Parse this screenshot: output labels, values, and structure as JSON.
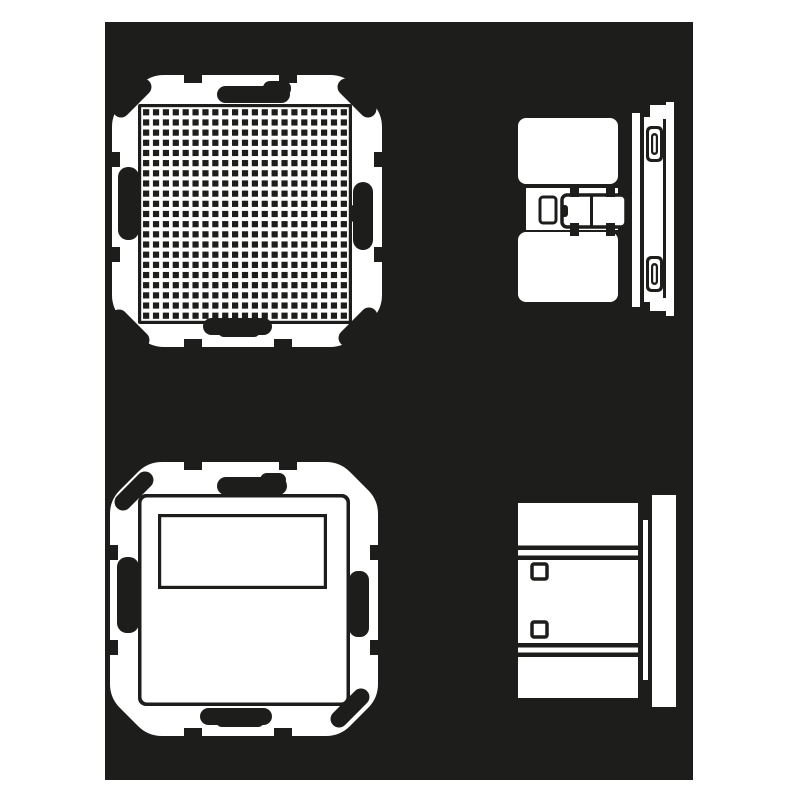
{
  "page": {
    "background": "#ffffff"
  },
  "canvas": {
    "background": "#1d1d1b",
    "ink": "#1d1d1b",
    "paper": "#ffffff",
    "x": 105,
    "y": 22,
    "width": 588,
    "height": 758
  },
  "figures": [
    {
      "id": "front-view-speaker-module",
      "kind": "front-view",
      "grille": {
        "rows": 21,
        "cols": 21
      }
    },
    {
      "id": "side-view-speaker-module",
      "kind": "side-view"
    },
    {
      "id": "front-view-display-module",
      "kind": "front-view",
      "window": {
        "shape": "rectangle"
      }
    },
    {
      "id": "side-view-display-module",
      "kind": "side-view"
    }
  ]
}
